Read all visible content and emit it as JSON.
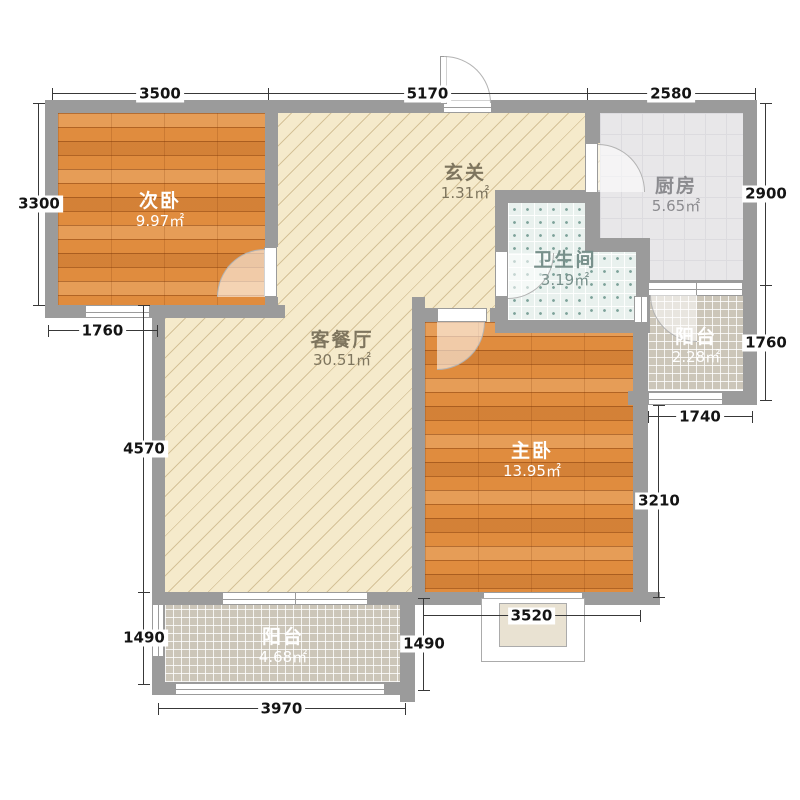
{
  "rooms": {
    "ciwo": {
      "name": "次卧",
      "area": "9.97㎡"
    },
    "kecanting": {
      "name": "客餐厅",
      "area": "30.51㎡"
    },
    "xuanguan": {
      "name": "玄关",
      "area": "1.31㎡"
    },
    "chufang": {
      "name": "厨房",
      "area": "5.65㎡"
    },
    "weishengjian": {
      "name": "卫生间",
      "area": "3.19㎡"
    },
    "zhuwo": {
      "name": "主卧",
      "area": "13.95㎡"
    },
    "yangtai_right": {
      "name": "阳台",
      "area": "2.28㎡"
    },
    "yangtai_bottom": {
      "name": "阳台",
      "area": "4.68㎡"
    }
  },
  "dimensions": {
    "top_left": "3500",
    "top_mid": "5170",
    "top_right": "2580",
    "left_upper": "3300",
    "left_window": "1760",
    "left_mid": "4570",
    "left_lower": "1490",
    "bottom": "3970",
    "inner_lower": "1490",
    "bay": "3520",
    "right_bedroom": "3210",
    "right_balcony_bottom": "1740",
    "right_balcony": "1760",
    "right_kitchen": "2900"
  },
  "colors": {
    "wall": "#9b9b9b",
    "wood_floor": "#e08c3e",
    "living_floor": "#f5eacb",
    "kitchen_tile": "#e8e7e9",
    "bath_tile": "#e9f1ee",
    "balcony_tile": "#ccc6b9",
    "dimension_line": "#383838"
  }
}
